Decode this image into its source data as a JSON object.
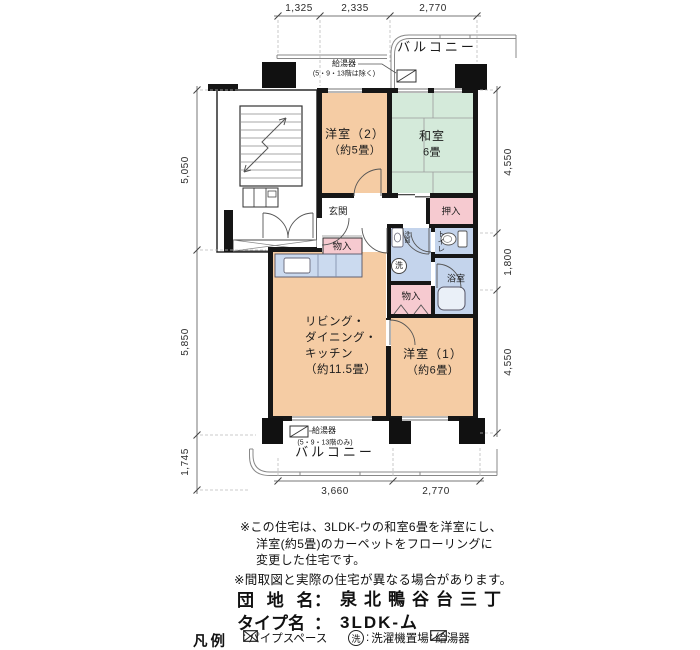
{
  "dimensions": {
    "top": [
      "1,325",
      "2,335",
      "2,770"
    ],
    "left": [
      "5,050",
      "5,850",
      "1,745"
    ],
    "right": [
      "4,550",
      "1,800",
      "4,550"
    ],
    "bottom": [
      "3,660",
      "2,770"
    ]
  },
  "balcony": {
    "top": "バルコニー",
    "bottom": "バルコニー"
  },
  "water_heater": {
    "top": {
      "label": "給湯器",
      "note": "(5・9・13階は除く)"
    },
    "bottom": {
      "label": "給湯器",
      "note": "(5・9・13階のみ)"
    }
  },
  "rooms": {
    "western2": {
      "name": "洋室（2）",
      "size": "（約5畳）"
    },
    "japanese": {
      "name": "和室",
      "size": "6畳"
    },
    "entrance": {
      "name": "玄関"
    },
    "storage_hall": {
      "name": "物入"
    },
    "oshiire": {
      "name": "押入"
    },
    "washroom": {
      "name": "洗面"
    },
    "laundry": {
      "name": "洗"
    },
    "toilet": {
      "name": "トイレ"
    },
    "bath": {
      "name": "浴室"
    },
    "storage_mid": {
      "name": "物入"
    },
    "ldk": {
      "lines": [
        "リビング・",
        "ダイニング・",
        "キッチン",
        "（約11.5畳）"
      ]
    },
    "western1": {
      "name": "洋室（1）",
      "size": "（約6畳）"
    }
  },
  "notes": [
    "※この住宅は、3LDK-ウの和室6畳を洋室にし、",
    "洋室(約5畳)のカーペットをフローリングに",
    "変更した住宅です。",
    "※間取図と実際の住宅が異なる場合があります。"
  ],
  "title_block": {
    "estate_label": "団 地 名",
    "estate_colon": "：",
    "estate_value": "泉北鴨谷台三丁",
    "type_label": "タイプ名",
    "type_colon": "：",
    "type_value": "3LDK-ム"
  },
  "legend": {
    "title": "凡例",
    "items": [
      {
        "colon": ":",
        "label": "パイプスペース"
      },
      {
        "symbol": "洗",
        "colon": ":",
        "label": "洗濯機置場"
      },
      {
        "colon": ":",
        "label": "給湯器"
      }
    ]
  },
  "colors": {
    "western_room": "#F5CCA4",
    "japanese_room": "#D4EADA",
    "closet": "#F6CAD0",
    "wet_area": "#C4D4EC",
    "counter": "#CBDAEF",
    "wall": "#161616"
  }
}
